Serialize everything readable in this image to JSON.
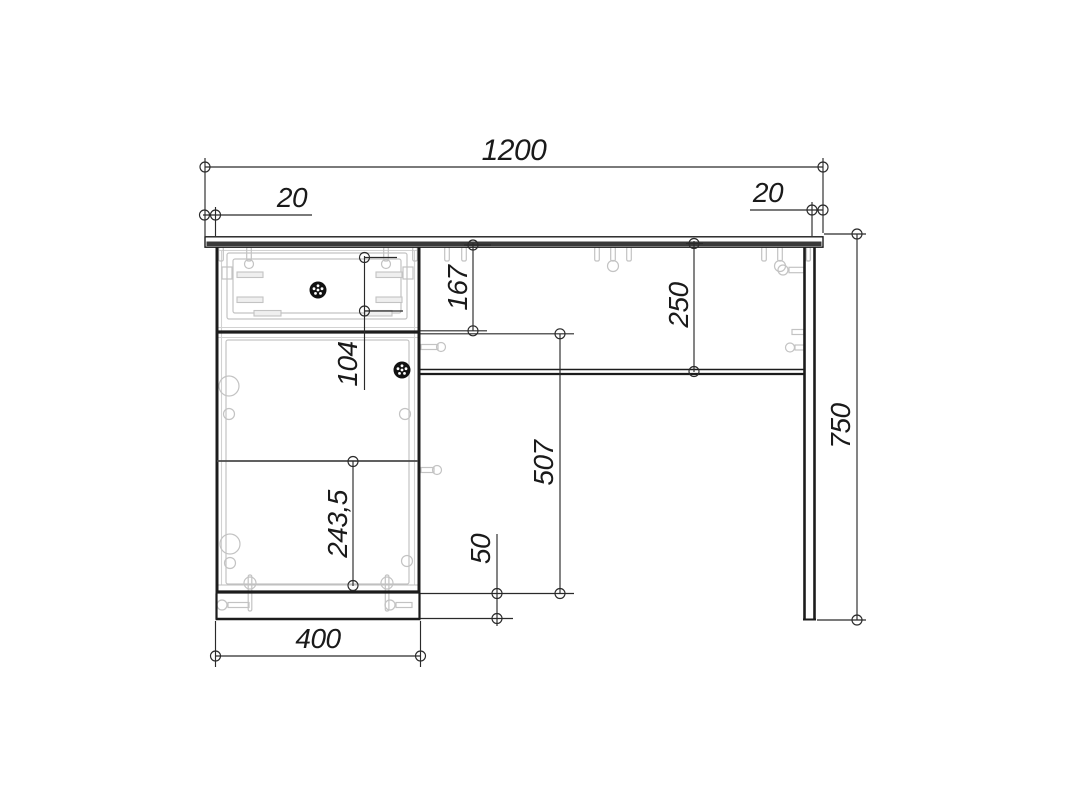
{
  "drawing": {
    "dims": {
      "total_width": "1200",
      "left_overhang": "20",
      "right_overhang": "20",
      "drawer_section_height": "167",
      "apron_offset": "250",
      "drawer_front_height": "104",
      "door_section_height": "507",
      "plinth_height": "50",
      "shelf_spacing": "243,5",
      "pedestal_width": "400",
      "overall_height": "750"
    },
    "colors": {
      "line": "#1c1c1c",
      "dimension": "#2a2a2a",
      "hardware": "#c3c3c3",
      "background": "#ffffff",
      "knob": "#111111"
    }
  }
}
